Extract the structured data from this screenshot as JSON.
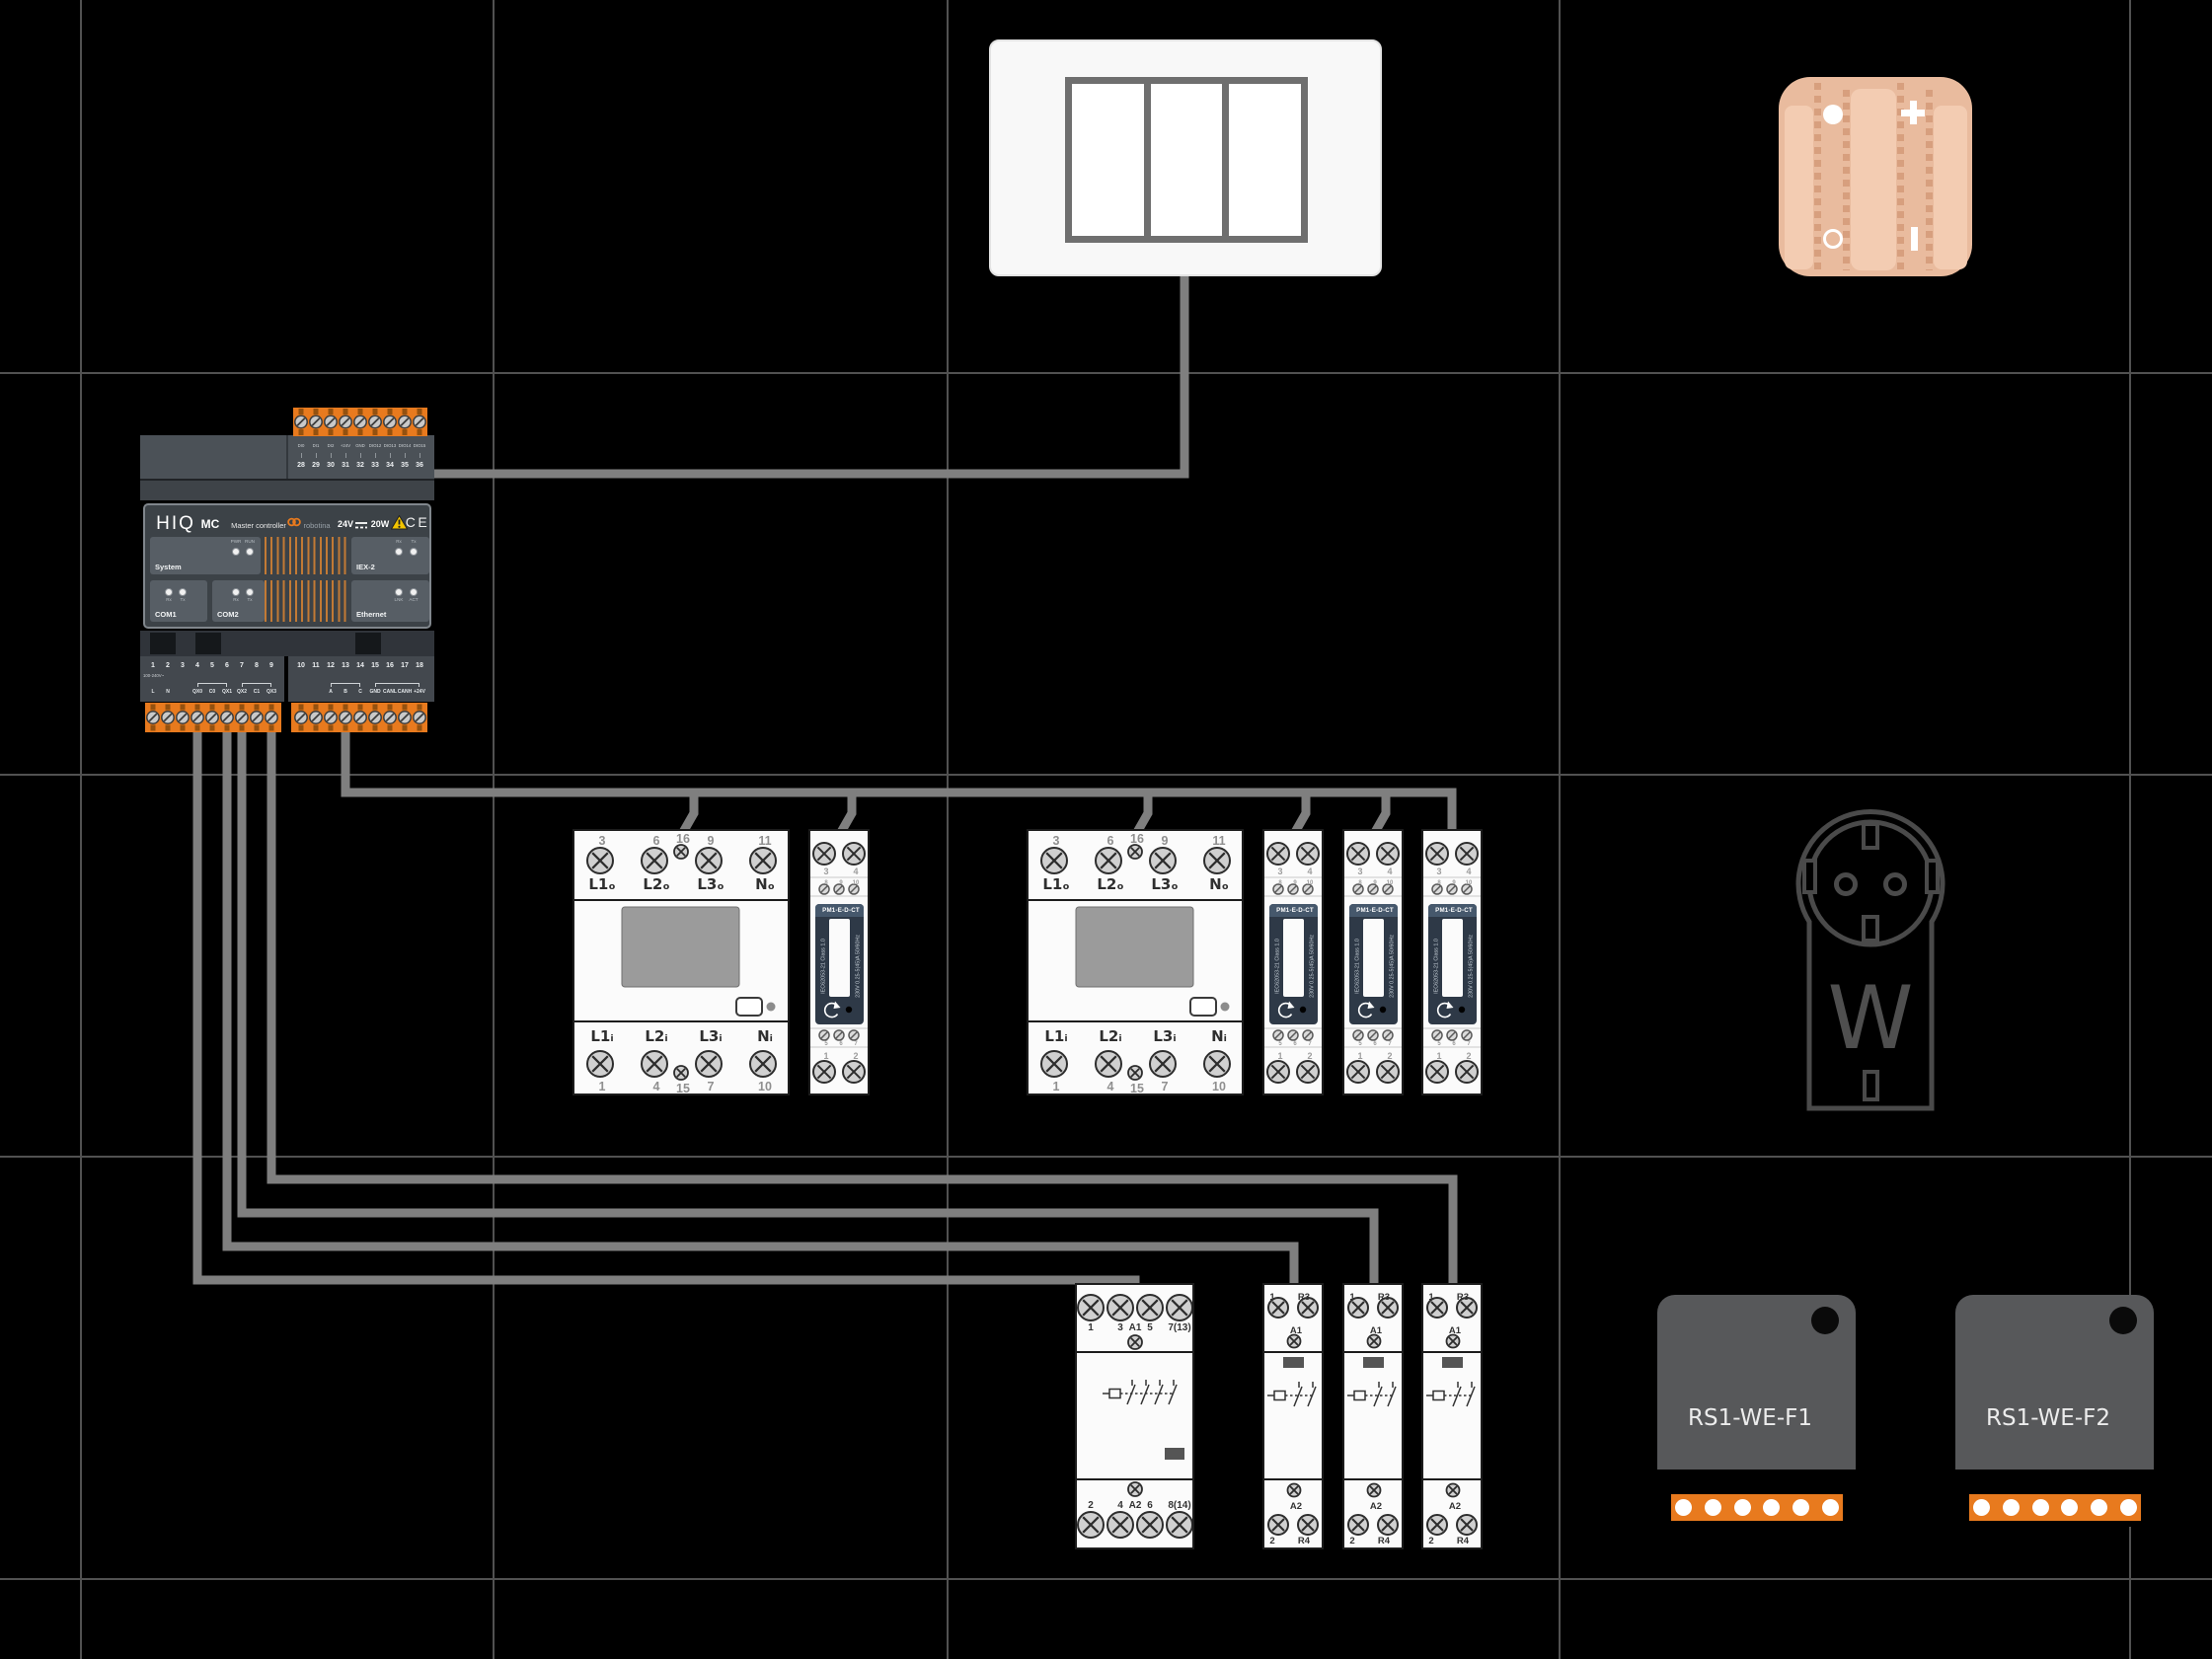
{
  "colors": {
    "accent_orange": "#e87a1e",
    "wire_gray": "#7f7f7f",
    "grid_gray": "#515151",
    "meter_navy": "#2e3947",
    "peach": "#e9bb9e"
  },
  "controller": {
    "brand": "HIQ",
    "model": "MC",
    "model_name": "Master controller",
    "logo_text": "robotina",
    "power_left": "24V",
    "power_right": "20W",
    "warn": "!",
    "ce": "CE",
    "top": {
      "labels": [
        "DI0",
        "DI1",
        "DI2",
        "+24V",
        "GND",
        "DIO12",
        "DIO13",
        "DIO14",
        "DIO15"
      ],
      "numbers": [
        "28",
        "29",
        "30",
        "31",
        "32",
        "33",
        "34",
        "35",
        "36"
      ]
    },
    "panels": {
      "system": {
        "label": "System",
        "led1": "PWR",
        "led2": "RUN"
      },
      "iex2": {
        "label": "IEX-2",
        "led1": "Rx",
        "led2": "Tx"
      },
      "com1": {
        "label": "COM1",
        "led1": "Rx",
        "led2": "Tx"
      },
      "com2": {
        "label": "COM2",
        "led1": "Rx",
        "led2": "Tx"
      },
      "ethernet": {
        "label": "Ethernet",
        "led1": "LNK",
        "led2": "ACT"
      }
    },
    "bottom_left": {
      "numbers": [
        "1",
        "2",
        "3",
        "4",
        "5",
        "6",
        "7",
        "8",
        "9"
      ],
      "voltage": "100-240V~",
      "terms": [
        "L",
        "N",
        "QX0",
        "C0",
        "QX1",
        "QX2",
        "C1",
        "QX3"
      ]
    },
    "bottom_right": {
      "numbers": [
        "10",
        "11",
        "12",
        "13",
        "14",
        "15",
        "16",
        "17",
        "18"
      ],
      "terms": [
        "A",
        "B",
        "C",
        "GND",
        "CANL",
        "CANH",
        "+24V"
      ]
    }
  },
  "meter3p": {
    "top_numbers": [
      "3",
      "6",
      "16",
      "9",
      "11"
    ],
    "top_labels": [
      "L1ₒ",
      "L2ₒ",
      "L3ₒ",
      "Nₒ"
    ],
    "bottom_labels": [
      "L1ᵢ",
      "L2ᵢ",
      "L3ᵢ",
      "Nᵢ"
    ],
    "bottom_numbers": [
      "1",
      "4",
      "15",
      "7",
      "10"
    ]
  },
  "pm1": {
    "title": "PM1-E-D-CT",
    "top_numbers": [
      "3",
      "4"
    ],
    "upper_screw_numbers": [
      "8",
      "9",
      "10"
    ],
    "side_left": "IEC62053-21 Class 1.0",
    "side_right": "230V 0.25-5(45)A 50/60Hz",
    "lower_screw_numbers": [
      "5",
      "6",
      "7"
    ],
    "bottom_numbers": [
      "1",
      "2"
    ]
  },
  "contactor": {
    "top_labels": [
      "1",
      "3",
      "A1",
      "5",
      "7(13)"
    ],
    "bottom_labels": [
      "2",
      "4",
      "A2",
      "6",
      "8(14)"
    ]
  },
  "relay": {
    "top_left": "1",
    "top_right": "R3",
    "coil_top": "A1",
    "coil_bottom": "A2",
    "bottom_left": "2",
    "bottom_right": "R4"
  },
  "rs1_modules": [
    {
      "label": "RS1-WE-F1"
    },
    {
      "label": "RS1-WE-F2"
    }
  ],
  "socket": {
    "label": "W"
  }
}
